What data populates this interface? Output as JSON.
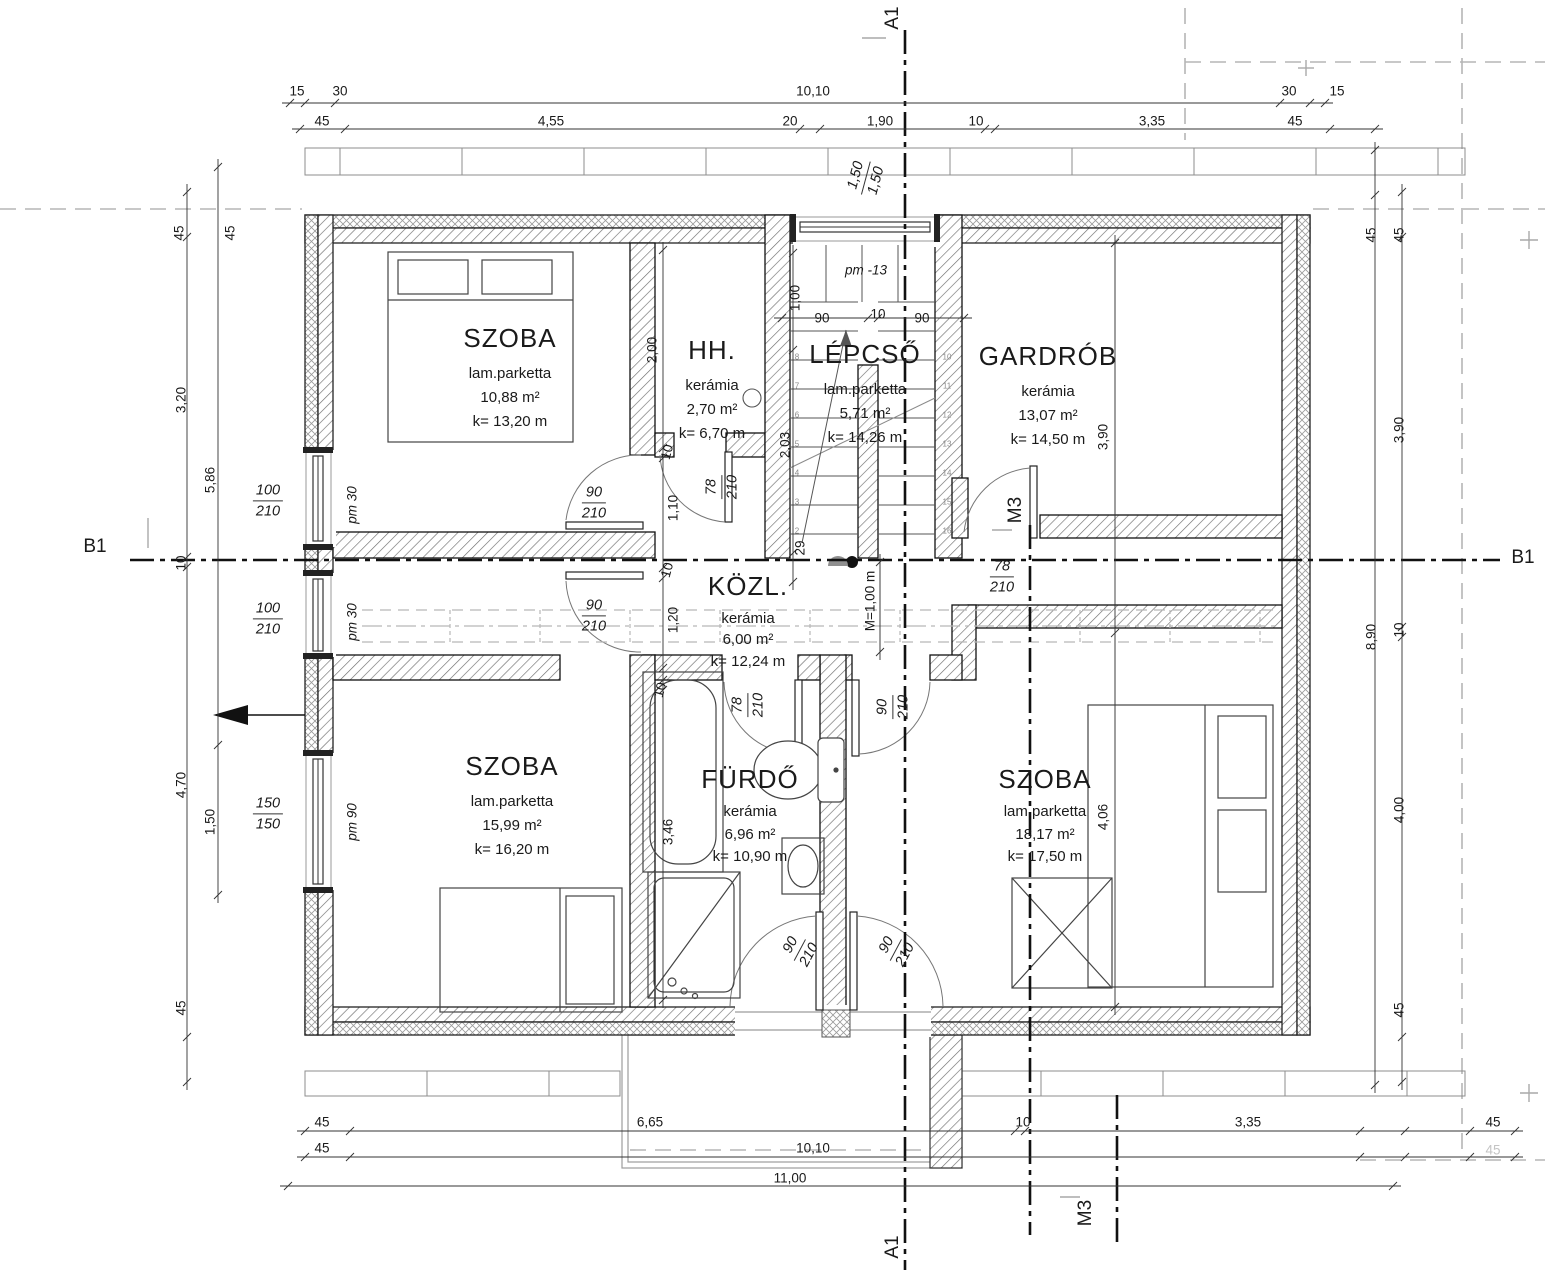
{
  "drawing": {
    "rooms": [
      {
        "name": "SZOBA",
        "floor": "lam.parketta",
        "area": "10,88 m²",
        "perimeter": "k= 13,20 m"
      },
      {
        "name": "HH.",
        "floor": "kerámia",
        "area": "2,70 m²",
        "perimeter": "k= 6,70 m"
      },
      {
        "name": "LÉPCSŐ",
        "floor": "lam.parketta",
        "area": "5,71 m²",
        "perimeter": "k= 14,26 m"
      },
      {
        "name": "GARDRÓB",
        "floor": "kerámia",
        "area": "13,07 m²",
        "perimeter": "k= 14,50 m"
      },
      {
        "name": "KÖZL.",
        "floor": "kerámia",
        "area": "6,00 m²",
        "perimeter": "k= 12,24 m"
      },
      {
        "name": "SZOBA",
        "floor": "lam.parketta",
        "area": "15,99 m²",
        "perimeter": "k= 16,20 m"
      },
      {
        "name": "FÜRDŐ",
        "floor": "kerámia",
        "area": "6,96 m²",
        "perimeter": "k= 10,90 m"
      },
      {
        "name": "SZOBA",
        "floor": "lam.parketta",
        "area": "18,17 m²",
        "perimeter": "k= 17,50 m"
      }
    ],
    "dim_labels": [
      {
        "t": "15",
        "x": 297,
        "y": 91
      },
      {
        "t": "30",
        "x": 340,
        "y": 91
      },
      {
        "t": "10,10",
        "x": 813,
        "y": 91
      },
      {
        "t": "30",
        "x": 1289,
        "y": 91
      },
      {
        "t": "15",
        "x": 1337,
        "y": 91
      },
      {
        "t": "45",
        "x": 322,
        "y": 121
      },
      {
        "t": "4,55",
        "x": 551,
        "y": 121
      },
      {
        "t": "20",
        "x": 790,
        "y": 121
      },
      {
        "t": "1,90",
        "x": 880,
        "y": 121
      },
      {
        "t": "10",
        "x": 976,
        "y": 121
      },
      {
        "t": "3,35",
        "x": 1152,
        "y": 121
      },
      {
        "t": "45",
        "x": 1295,
        "y": 121
      },
      {
        "t": "pm -13",
        "x": 866,
        "y": 270,
        "i": 1
      },
      {
        "t": "1,00",
        "x": 795,
        "y": 298,
        "r": -90
      },
      {
        "t": "90",
        "x": 822,
        "y": 318
      },
      {
        "t": "10",
        "x": 878,
        "y": 314
      },
      {
        "t": "90",
        "x": 922,
        "y": 318
      },
      {
        "t": "45",
        "x": 179,
        "y": 233,
        "r": -90
      },
      {
        "t": "45",
        "x": 230,
        "y": 233,
        "r": -90
      },
      {
        "t": "3,20",
        "x": 181,
        "y": 400,
        "r": -90
      },
      {
        "t": "5,86",
        "x": 210,
        "y": 480,
        "r": -90
      },
      {
        "t": "10",
        "x": 181,
        "y": 563,
        "r": -90
      },
      {
        "t": "4,70",
        "x": 181,
        "y": 785,
        "r": -90
      },
      {
        "t": "1,50",
        "x": 210,
        "y": 822,
        "r": -90
      },
      {
        "t": "45",
        "x": 181,
        "y": 1008,
        "r": -90
      },
      {
        "t": "pm 30",
        "x": 352,
        "y": 505,
        "r": -90,
        "i": 1
      },
      {
        "t": "pm 30",
        "x": 352,
        "y": 622,
        "r": -90,
        "i": 1
      },
      {
        "t": "pm 90",
        "x": 352,
        "y": 822,
        "r": -90,
        "i": 1
      },
      {
        "t": "B1",
        "x": 95,
        "y": 547,
        "cls": "marker"
      },
      {
        "t": "B1",
        "x": 1523,
        "y": 558,
        "cls": "marker"
      },
      {
        "t": "A1",
        "x": 893,
        "y": 18,
        "r": -90,
        "cls": "marker"
      },
      {
        "t": "A1",
        "x": 893,
        "y": 1247,
        "r": -90,
        "cls": "marker"
      },
      {
        "t": "M3",
        "x": 1016,
        "y": 510,
        "r": -90,
        "cls": "marker"
      },
      {
        "t": "M3",
        "x": 1086,
        "y": 1213,
        "r": -90,
        "cls": "marker"
      },
      {
        "t": "45",
        "x": 1371,
        "y": 235,
        "r": -90
      },
      {
        "t": "45",
        "x": 1399,
        "y": 235,
        "r": -90
      },
      {
        "t": "3,90",
        "x": 1399,
        "y": 430,
        "r": -90
      },
      {
        "t": "8,90",
        "x": 1371,
        "y": 637,
        "r": -90
      },
      {
        "t": "10",
        "x": 1399,
        "y": 630,
        "r": -90
      },
      {
        "t": "4,00",
        "x": 1399,
        "y": 810,
        "r": -90
      },
      {
        "t": "45",
        "x": 1399,
        "y": 1010,
        "r": -90
      },
      {
        "t": "45",
        "x": 322,
        "y": 1122
      },
      {
        "t": "6,65",
        "x": 650,
        "y": 1122
      },
      {
        "t": "10",
        "x": 1023,
        "y": 1122
      },
      {
        "t": "3,35",
        "x": 1248,
        "y": 1122
      },
      {
        "t": "45",
        "x": 1493,
        "y": 1122
      },
      {
        "t": "45",
        "x": 322,
        "y": 1148
      },
      {
        "t": "10,10",
        "x": 813,
        "y": 1148
      },
      {
        "t": "45",
        "x": 1493,
        "y": 1150,
        "cls": "faded"
      },
      {
        "t": "11,00",
        "x": 790,
        "y": 1178
      },
      {
        "t": "2,00",
        "x": 652,
        "y": 350,
        "r": -90
      },
      {
        "t": "1,10",
        "x": 673,
        "y": 508,
        "r": -90
      },
      {
        "t": "10",
        "x": 667,
        "y": 452,
        "r": -75
      },
      {
        "t": "2,03",
        "x": 785,
        "y": 445,
        "r": -90
      },
      {
        "t": "29",
        "x": 800,
        "y": 548,
        "r": -90
      },
      {
        "t": "1,20",
        "x": 673,
        "y": 620,
        "r": -90
      },
      {
        "t": "10",
        "x": 667,
        "y": 570,
        "r": -75
      },
      {
        "t": "M=1,00 m",
        "x": 870,
        "y": 601,
        "r": -90
      },
      {
        "t": "10",
        "x": 660,
        "y": 690,
        "r": -75
      },
      {
        "t": "3,46",
        "x": 668,
        "y": 832,
        "r": -90
      },
      {
        "t": "3,90",
        "x": 1103,
        "y": 437,
        "r": -90
      },
      {
        "t": "4,06",
        "x": 1103,
        "y": 817,
        "r": -90
      }
    ],
    "frac_labels": [
      {
        "a": "1,50",
        "b": "1,50",
        "x": 866,
        "y": 178,
        "r": -75
      },
      {
        "a": "100",
        "b": "210",
        "x": 268,
        "y": 501
      },
      {
        "a": "100",
        "b": "210",
        "x": 268,
        "y": 619
      },
      {
        "a": "150",
        "b": "150",
        "x": 268,
        "y": 814
      },
      {
        "a": "90",
        "b": "210",
        "x": 594,
        "y": 503
      },
      {
        "a": "90",
        "b": "210",
        "x": 594,
        "y": 616
      },
      {
        "a": "78",
        "b": "210",
        "x": 1002,
        "y": 577
      },
      {
        "a": "78",
        "b": "210",
        "x": 722,
        "y": 487,
        "r": -90
      },
      {
        "a": "78",
        "b": "210",
        "x": 748,
        "y": 705,
        "r": -90
      },
      {
        "a": "90",
        "b": "210",
        "x": 893,
        "y": 707,
        "r": -90
      },
      {
        "a": "90",
        "b": "210",
        "x": 800,
        "y": 950,
        "r": -62
      },
      {
        "a": "90",
        "b": "210",
        "x": 896,
        "y": 950,
        "r": -62
      }
    ],
    "stair_steps": {
      "left": [
        "8",
        "7",
        "6",
        "5",
        "4",
        "3",
        "2"
      ],
      "right": [
        "10",
        "11",
        "12",
        "13",
        "14",
        "15",
        "16"
      ]
    }
  }
}
